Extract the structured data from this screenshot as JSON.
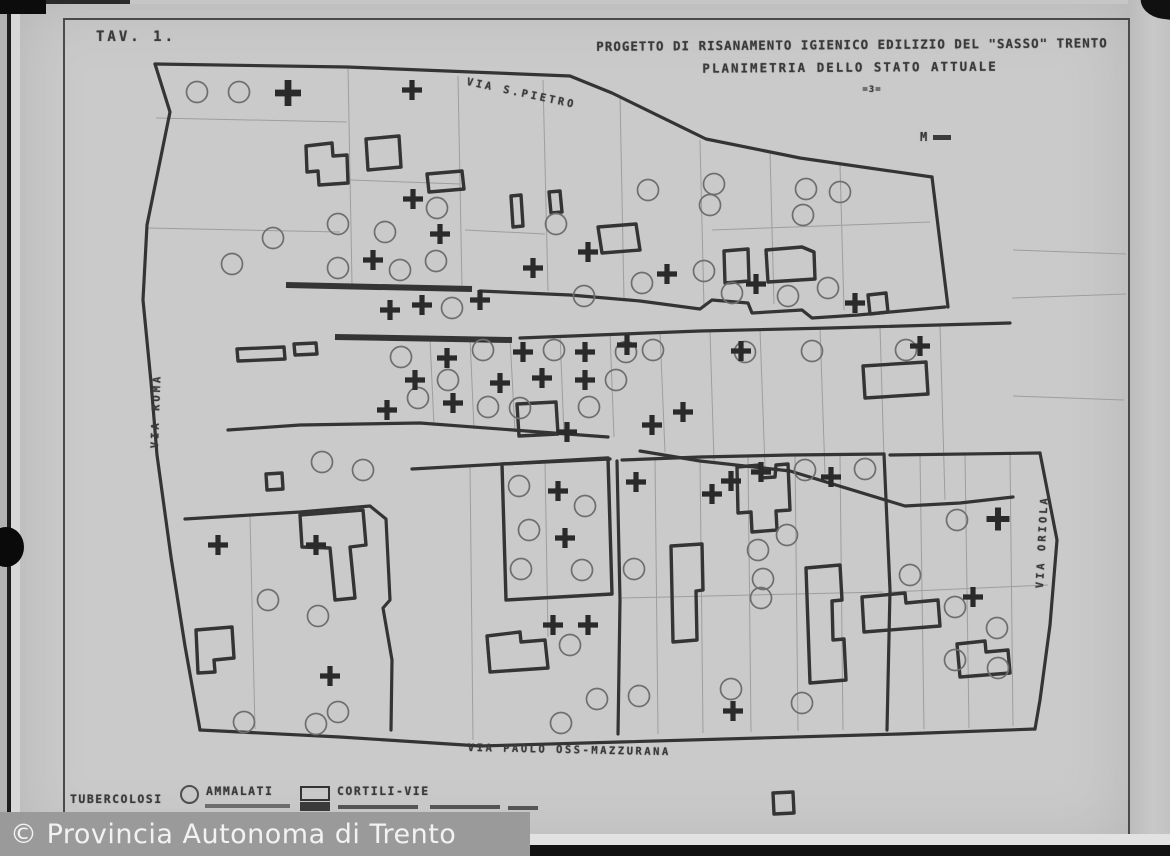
{
  "titles": {
    "sheet_number": "TAV. 1.",
    "line1": "PROGETTO DI RISANAMENTO IGIENICO EDILIZIO DEL \"SASSO\" TRENTO",
    "line2": "PLANIMETRIA DELLO STATO ATTUALE",
    "scale_note": "=3=",
    "north_mark": "M"
  },
  "streets": [
    {
      "label": "VIA S.PIETRO"
    },
    {
      "label": "VIA ROMA"
    },
    {
      "label": "VIA ORIOLA"
    },
    {
      "label": "VIA PAOLO OSS-MAZZURANA"
    }
  ],
  "legend": {
    "items": [
      {
        "symbol": "none",
        "label": "TUBERCOLOSI"
      },
      {
        "symbol": "circle-icon",
        "label": "AMMALATI"
      },
      {
        "symbol": "rect-icon",
        "label": "CORTILI-VIE"
      }
    ]
  },
  "watermark": {
    "text": "© Provincia Autonoma di Trento"
  },
  "colors": {
    "paper": "#c7c7c7",
    "line": "#343434",
    "thin": "#9e9e9e",
    "circle": "#6e6e6e",
    "cross": "#2a2a2a",
    "watermark_bg": "#9a9a9a",
    "watermark_fg": "#f2f2f2"
  },
  "map": {
    "outlines": [
      "M155,64 L347,67 L570,76 L612,93 L706,139 L800,158 L932,177",
      "M155,64 L170,112 L147,225 L143,300 L151,382 L157,455 L171,557 L185,646 L200,730",
      "M932,177 L948,307",
      "M480,291 L570,295 L640,301 L700,309 L712,300 L748,303 L752,313 L802,310 L812,318 L858,315 L945,307",
      "M520,338 L700,331 L830,328 L1010,323",
      "M228,430 L300,425 L420,423 L540,432 L608,437",
      "M640,451 L700,461 L790,471 L905,506 L960,503 L1013,497",
      "M200,730 L340,737 L480,746 L620,742 L760,738 L900,734 L1035,729",
      "M1040,453 L1057,540 L1050,625 L1040,700 L1035,729",
      "M617,461 L620,600 L618,734",
      "M884,454 L890,590 L887,730",
      "M185,519 L300,512 L370,506 L386,519 L390,600 L383,608 L392,660 L391,730",
      "M622,460 L700,457 L790,455 L884,454",
      "M890,455 L1040,453",
      "M412,469 L502,464 L610,459"
    ],
    "bars": [
      "M286,285 L472,289",
      "M335,337 L512,340"
    ],
    "buildings": [
      "M306,146 L332,143 L333,156 L347,155 L348,183 L319,185 L318,171 L307,172 Z",
      "M366,139 L399,136 L401,167 L368,170 Z",
      "M427,174 L462,171 L464,189 L429,192 Z",
      "M511,196 L521,195 L523,226 L513,227 Z",
      "M549,192 L560,191 L562,212 L551,213 Z",
      "M598,227 L636,224 L640,250 L602,253 Z",
      "M724,251 L748,249 L749,281 L725,283 Z",
      "M766,250 L802,247 L814,252 L815,279 L768,282 Z",
      "M868,295 L886,293 L888,312 L870,314 Z",
      "M237,349 L284,347 L285,359 L238,361 Z",
      "M294,344 L316,343 L317,354 L295,355 Z",
      "M863,366 L926,362 L928,394 L865,398 Z",
      "M517,404 L556,402 L558,434 L519,436 Z",
      "M266,474 L282,473 L283,489 L267,490 Z",
      "M300,515 L363,510 L366,545 L350,547 L355,598 L335,600 L330,548 L302,547 Z",
      "M196,630 L232,627 L234,658 L214,660 L215,672 L198,673 Z",
      "M487,636 L520,632 L521,642 L545,640 L548,668 L490,672 Z",
      "M502,464 L608,458 L612,594 L506,600 Z",
      "M671,546 L702,544 L703,590 L696,591 L697,640 L673,642 Z",
      "M737,467 L760,465 L761,478 L775,477 L776,465 L788,464 L790,510 L776,511 L777,530 L752,532 L751,512 L738,513 Z",
      "M806,568 L840,565 L842,600 L832,601 L833,640 L844,639 L846,680 L810,683 Z",
      "M862,597 L905,593 L906,603 L938,600 L940,626 L864,632 Z",
      "M957,644 L985,641 L986,652 L1008,650 L1010,673 L960,677 Z",
      "M773,793 L793,792 L794,813 L774,814 Z"
    ],
    "thin_lines": [
      "M348,67 L352,284",
      "M458,76 L462,289",
      "M543,80 L548,291",
      "M620,95 L624,300",
      "M700,140 L704,308",
      "M770,152 L774,304",
      "M840,165 L844,310",
      "M156,118 L347,122",
      "M148,228 L340,232",
      "M350,180 L460,184",
      "M465,230 L545,234",
      "M712,230 L930,222",
      "M430,339 L434,426",
      "M470,338 L474,429",
      "M510,337 L515,432",
      "M560,335 L564,434",
      "M610,333 L614,437",
      "M660,332 L665,452",
      "M710,331 L714,461",
      "M760,330 L765,467",
      "M820,328 L825,473",
      "M880,327 L885,492",
      "M940,325 L945,500",
      "M655,458 L658,734",
      "M700,457 L703,733",
      "M748,456 L751,732",
      "M795,455 L798,731",
      "M840,455 L843,730",
      "M920,455 L924,729",
      "M965,454 L969,728",
      "M1010,454 L1013,726",
      "M250,517 L255,729",
      "M470,465 L473,740",
      "M545,461 L548,637",
      "M622,598 L883,592",
      "M890,592 L1048,585",
      "M1013,250 L1126,254",
      "M1012,298 L1126,294",
      "M1013,396 L1124,400"
    ],
    "circles": [
      [
        197,
        92
      ],
      [
        239,
        92
      ],
      [
        273,
        238
      ],
      [
        232,
        264
      ],
      [
        338,
        224
      ],
      [
        385,
        232
      ],
      [
        437,
        208
      ],
      [
        436,
        261
      ],
      [
        338,
        268
      ],
      [
        400,
        270
      ],
      [
        452,
        308
      ],
      [
        556,
        224
      ],
      [
        648,
        190
      ],
      [
        714,
        184
      ],
      [
        710,
        205
      ],
      [
        806,
        189
      ],
      [
        840,
        192
      ],
      [
        803,
        215
      ],
      [
        704,
        271
      ],
      [
        732,
        293
      ],
      [
        788,
        296
      ],
      [
        828,
        288
      ],
      [
        642,
        283
      ],
      [
        584,
        296
      ],
      [
        401,
        357
      ],
      [
        483,
        350
      ],
      [
        554,
        350
      ],
      [
        448,
        380
      ],
      [
        418,
        398
      ],
      [
        488,
        407
      ],
      [
        589,
        407
      ],
      [
        626,
        352
      ],
      [
        653,
        350
      ],
      [
        616,
        380
      ],
      [
        745,
        352
      ],
      [
        812,
        351
      ],
      [
        906,
        350
      ],
      [
        520,
        408
      ],
      [
        322,
        462
      ],
      [
        363,
        470
      ],
      [
        268,
        600
      ],
      [
        318,
        616
      ],
      [
        338,
        712
      ],
      [
        316,
        724
      ],
      [
        244,
        722
      ],
      [
        519,
        486
      ],
      [
        585,
        506
      ],
      [
        529,
        530
      ],
      [
        521,
        569
      ],
      [
        582,
        570
      ],
      [
        634,
        569
      ],
      [
        570,
        645
      ],
      [
        561,
        723
      ],
      [
        597,
        699
      ],
      [
        639,
        696
      ],
      [
        758,
        550
      ],
      [
        763,
        579
      ],
      [
        761,
        598
      ],
      [
        787,
        535
      ],
      [
        731,
        689
      ],
      [
        802,
        703
      ],
      [
        805,
        470
      ],
      [
        865,
        469
      ],
      [
        910,
        575
      ],
      [
        957,
        520
      ],
      [
        955,
        607
      ],
      [
        997,
        628
      ],
      [
        955,
        660
      ],
      [
        998,
        668
      ]
    ],
    "crosses": [
      [
        288,
        93,
        1.3
      ],
      [
        412,
        90
      ],
      [
        413,
        199
      ],
      [
        440,
        234
      ],
      [
        373,
        260
      ],
      [
        533,
        268
      ],
      [
        588,
        252
      ],
      [
        667,
        274
      ],
      [
        756,
        284
      ],
      [
        855,
        303
      ],
      [
        480,
        300
      ],
      [
        422,
        305
      ],
      [
        390,
        310
      ],
      [
        447,
        358
      ],
      [
        415,
        380
      ],
      [
        500,
        383
      ],
      [
        542,
        378
      ],
      [
        585,
        352
      ],
      [
        585,
        380
      ],
      [
        523,
        352
      ],
      [
        627,
        345
      ],
      [
        453,
        403
      ],
      [
        387,
        410
      ],
      [
        567,
        432
      ],
      [
        652,
        425
      ],
      [
        741,
        351
      ],
      [
        683,
        412
      ],
      [
        920,
        346
      ],
      [
        558,
        491
      ],
      [
        565,
        538
      ],
      [
        636,
        482
      ],
      [
        712,
        494
      ],
      [
        731,
        481
      ],
      [
        761,
        472
      ],
      [
        553,
        625
      ],
      [
        588,
        625
      ],
      [
        733,
        711
      ],
      [
        831,
        477
      ],
      [
        218,
        545
      ],
      [
        316,
        545
      ],
      [
        330,
        676
      ],
      [
        998,
        519,
        1.15
      ],
      [
        973,
        597
      ]
    ]
  }
}
